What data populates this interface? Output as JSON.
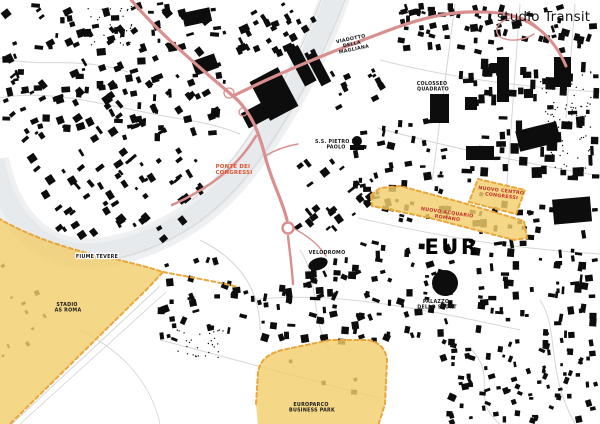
{
  "brand": {
    "name": "studio Transit"
  },
  "colors": {
    "background": "#ffffff",
    "building": "#0d0d0d",
    "river": "#e7eaec",
    "river_bank": "#eef0f2",
    "street": "#d6d6d6",
    "zone_fill": "#f2ce6d",
    "zone_border": "#e9a63b",
    "road_red": "#d98f8d",
    "label_red": "#c5302c",
    "label_orange": "#e4512b",
    "label_black": "#1a1a1a"
  },
  "labels": {
    "viadotto_della_magliana": {
      "lines": [
        "VIADOTTO",
        "DELLA",
        "MAGLIANA"
      ]
    },
    "colosseo_quadrato": {
      "lines": [
        "COLOSSEO",
        "QUADRATO"
      ]
    },
    "ss_pietro_e_paolo": {
      "lines": [
        "S.S. PIETRO E",
        "PAOLO"
      ]
    },
    "ponte_dei_congressi": {
      "lines": [
        "PONTE DEI",
        "CONGRESSI"
      ]
    },
    "fiume_tevere": {
      "lines": [
        "FIUME TEVERE"
      ]
    },
    "stadio_as_roma": {
      "lines": [
        "STADIO",
        "AS ROMA"
      ]
    },
    "velodromo": {
      "lines": [
        "VELODROMO"
      ]
    },
    "eur": {
      "lines": [
        "EUR"
      ]
    },
    "palazzo_dello_sport": {
      "lines": [
        "PALAZZO",
        "DELLO SPORT"
      ]
    },
    "europarco_business_park": {
      "lines": [
        "EUROPARCO",
        "BUSINESS PARK"
      ]
    },
    "nuovo_acquario_romano": {
      "lines": [
        "NUOVO ACQUARIO",
        "ROMANO"
      ]
    },
    "nuovo_centro_congressi": {
      "lines": [
        "NUOVO CENTRO",
        "CONGRESSI"
      ]
    }
  },
  "zones": [
    {
      "name": "Stadio AS Roma"
    },
    {
      "name": "Europarco Business Park"
    },
    {
      "name": "Nuovo Acquario Romano"
    },
    {
      "name": "Nuovo Centro Congressi"
    }
  ]
}
